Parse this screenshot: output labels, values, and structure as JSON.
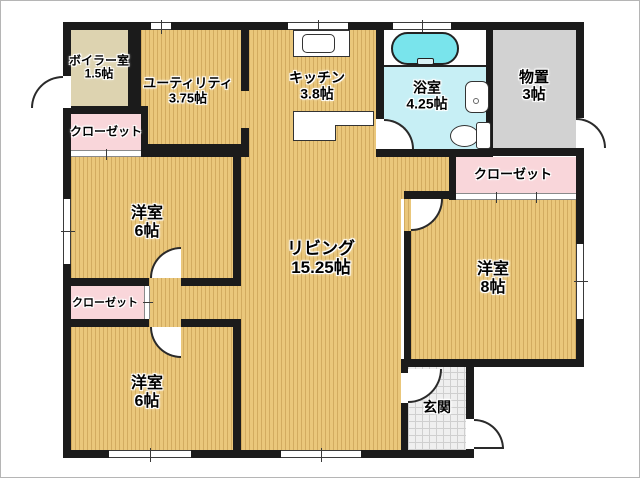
{
  "title": "floor-plan",
  "colors": {
    "wall": "#1b1b1b",
    "wood_floor": "#eac77b",
    "boiler_floor": "#ddd3b0",
    "closet_pink": "#f9d6da",
    "storage_gray": "#d2d2d2",
    "bath_cyan": "#c7eff5",
    "tub_cyan": "#79e4ec",
    "entrance_tile": "#efefef"
  },
  "rooms": {
    "boiler": {
      "label": "ボイラー室",
      "size": "1.5帖"
    },
    "closet_tl": {
      "label": "クローゼット"
    },
    "utility": {
      "label": "ユーティリティ",
      "size": "3.75帖"
    },
    "kitchen": {
      "label": "キッチン",
      "size": "3.8帖"
    },
    "bath": {
      "label": "浴室",
      "size": "4.25帖"
    },
    "storage": {
      "label": "物置",
      "size": "3帖"
    },
    "closet_tr": {
      "label": "クローゼット"
    },
    "west_room_1": {
      "label": "洋室",
      "size": "6帖"
    },
    "closet_ml": {
      "label": "クローゼット"
    },
    "west_room_2": {
      "label": "洋室",
      "size": "6帖"
    },
    "living": {
      "label": "リビング",
      "size": "15.25帖"
    },
    "west_room_3": {
      "label": "洋室",
      "size": "8帖"
    },
    "entrance": {
      "label": "玄関"
    }
  }
}
